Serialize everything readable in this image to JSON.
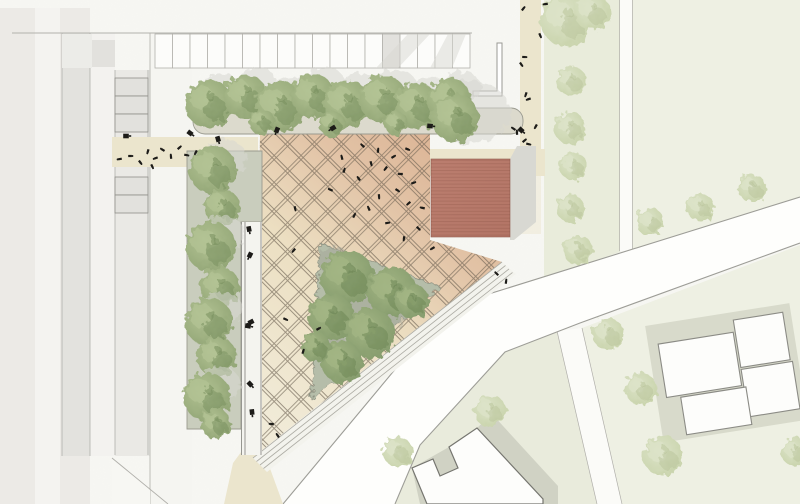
{
  "canvas": {
    "w": 800,
    "h": 504
  },
  "title": "site-plan",
  "colors": {
    "bg": "#f7f7f3",
    "noise": "#9a9a90",
    "slab": "#eceae6",
    "slab_seam": "#f4f3f0",
    "wing": "#e3e2de",
    "aisle": "#f3f2ef",
    "stall_col_bg": "#eae9e5",
    "sidewalk": "#f5f5f1",
    "stall_fill": "#fcfcfa",
    "stall_gray": "#e2e1dd",
    "stall_line": "#b2b1ac",
    "thin_line": "#b0afaa",
    "block_pale": "#eef0e3",
    "block_pale2": "#e9ebdc",
    "green_strip": "#e9ecdb",
    "street_white": "#fbfbf8",
    "road_fill": "#fefefc",
    "road_line": "#9d9d97",
    "beige": "#ebe5cd",
    "plaza_g1": "#f1ebd8",
    "plaza_g2": "#ecdfc2",
    "plaza_g3": "#e2c3a6",
    "plaza_g4": "#dcb495",
    "grid_line": "#6b5f50",
    "steps_fill": "#f3f3ed",
    "steps_line": "#adaca4",
    "planter_bed": "#dcdacd",
    "planter_strip": "#c9cdbd",
    "planter_line": "#9a9a8f",
    "walkway": "#f4f4ef",
    "wall_line": "#8d8c86",
    "triangle_fill": "#b5bda9",
    "triangle_line": "#8f9383",
    "triangle_spot": "#a3a698",
    "shadow": "#d8d8d2",
    "red_roof": "#b37566",
    "red_roof_hi": "#bb7e6f",
    "red_stripe": "#5a281e",
    "red_line": "#8f5a4d",
    "gray_bldg_shadow": "#d0d2c4",
    "bldg_white": "#fdfdfb",
    "bldg_line": "#75756f",
    "white_bldg_line": "#8b8b85",
    "white_bldg_shadow": "#d8dacb",
    "tree_g1": "#b3c394",
    "tree_g2": "#8ea272",
    "tree_g3": "#718a58",
    "tree_d1": "#a3b584",
    "tree_d2": "#82996a",
    "tree_d3": "#66804f",
    "tree_p1": "#dce3c8",
    "tree_p2": "#c7d2a9",
    "tree_p3": "#b5c296",
    "figure": "#1c1b18"
  },
  "left_complex": {
    "slab": [
      0,
      8,
      90,
      496
    ],
    "seam": [
      35,
      8,
      25,
      496
    ],
    "wing": [
      62,
      33,
      28,
      423
    ],
    "aisle": [
      90,
      33,
      25,
      423
    ],
    "stall_col": [
      115,
      70,
      35,
      386
    ],
    "sidewalk": [
      150,
      33,
      42,
      471
    ],
    "diag_cut": "112,458 150,490 150,504 112,504",
    "col_rows": [
      [
        115,
        78,
        33,
        18
      ],
      [
        115,
        96,
        33,
        18
      ],
      [
        115,
        114,
        33,
        18
      ],
      [
        115,
        177,
        33,
        18
      ],
      [
        115,
        195,
        33,
        18
      ]
    ]
  },
  "top_strip": {
    "edge_y": 33,
    "edge_x1": 12,
    "edge_x2": 472,
    "gray_a": [
      62,
      34,
      30,
      34
    ],
    "gray_b": [
      92,
      40,
      23,
      27
    ],
    "stalls": {
      "x": 155,
      "y": 34,
      "w": 17.5,
      "h": 34,
      "count": 18,
      "gray_index": 13
    },
    "shadow_polys": [
      "408,34 430,34 398,68 376,68",
      "448,34 466,34 452,68 430,68"
    ],
    "l_wall": "M473,91 h24 V43 h5 v53 h-29 z"
  },
  "right_blocks": {
    "top_right": "632,0 800,0 800,197 632,249",
    "green_strip": "544,0 620,0 620,252 544,278",
    "beige_strip": [
      520,
      0,
      21,
      176
    ],
    "beige_tail": [
      520,
      176,
      21,
      58
    ],
    "v_street": [
      620,
      0,
      12,
      251
    ],
    "bottom_center": "557,331 505,352 420,445 395,504 597,504",
    "bottom_right": "582,328 800,245 800,504 622,504",
    "street_below": "557,331 582,328 622,504 597,504"
  },
  "road": {
    "fill": "800,197 447,307 283,504 395,504 420,445 505,352 580,323 800,243",
    "upper_edge": "M800,197 L447,307 L283,504",
    "lower_edge": "M800,243 L580,323 L505,352 L420,445 L395,504"
  },
  "paths": {
    "band_w": [
      112,
      137,
      146,
      30
    ],
    "band_e": [
      428,
      149,
      117,
      27
    ],
    "sw_wedge": "250,440 264,452 283,504 224,504 233,463"
  },
  "plaza": {
    "outline": "260,133 430,133 430,240 502,262 310,412 256,455",
    "grid_cell": 19,
    "steps_band": "502,262 516,274 267,472 253,458",
    "steps_lines": [
      0,
      5,
      10,
      15
    ],
    "walkway": [
      241,
      222,
      21,
      233
    ],
    "triangle": "320,243 440,287 312,400",
    "triangle_spots": [
      [
        335,
        262,
        16
      ],
      [
        357,
        302,
        18
      ],
      [
        332,
        346,
        14
      ],
      [
        392,
        312,
        15
      ]
    ]
  },
  "planters": {
    "top_bed": [
      193,
      108,
      330,
      26
    ],
    "left_strip": "187,151 262,151 262,222 241,222 241,429 187,429"
  },
  "red_building": {
    "rect": [
      431,
      159,
      79,
      78
    ],
    "shadow": "510,159 517,146 536,146 536,222 514,240 510,240",
    "nw_shade": [
      468,
      112,
      42,
      32
    ]
  },
  "gray_building": {
    "shadow": "412,468 449,447 477,428 492,414 558,486 558,504 420,504",
    "outline": "M477,428 L543,499 L543,504 L427,504 L412,468 L433,459 L440,476 L458,468 L449,447 Z"
  },
  "white_buildings": {
    "rotate": [
      -9,
      725,
      370
    ],
    "shadow": [
      653,
      314,
      146,
      118
    ],
    "rects": [
      [
        663,
        334,
        76,
        54
      ],
      [
        741,
        322,
        50,
        48
      ],
      [
        741,
        372,
        52,
        48
      ],
      [
        677,
        390,
        66,
        38
      ]
    ]
  },
  "trees": [
    {
      "x": 209,
      "y": 104,
      "r": 24,
      "k": "g",
      "s": 1
    },
    {
      "x": 245,
      "y": 96,
      "r": 22,
      "k": "g",
      "s": 1
    },
    {
      "x": 280,
      "y": 107,
      "r": 25,
      "k": "g",
      "s": 1
    },
    {
      "x": 313,
      "y": 96,
      "r": 22,
      "k": "g",
      "s": 1
    },
    {
      "x": 347,
      "y": 104,
      "r": 24,
      "k": "g",
      "s": 1
    },
    {
      "x": 383,
      "y": 99,
      "r": 24,
      "k": "g",
      "s": 1
    },
    {
      "x": 417,
      "y": 106,
      "r": 23,
      "k": "g",
      "s": 1
    },
    {
      "x": 449,
      "y": 100,
      "r": 22,
      "k": "g",
      "s": 1
    },
    {
      "x": 262,
      "y": 122,
      "r": 13,
      "k": "g",
      "s": 0
    },
    {
      "x": 332,
      "y": 124,
      "r": 13,
      "k": "g",
      "s": 0
    },
    {
      "x": 396,
      "y": 123,
      "r": 12,
      "k": "g",
      "s": 0
    },
    {
      "x": 455,
      "y": 118,
      "r": 24,
      "k": "g",
      "s": 0
    },
    {
      "x": 213,
      "y": 170,
      "r": 24,
      "k": "g",
      "s": 1
    },
    {
      "x": 222,
      "y": 207,
      "r": 18,
      "k": "g",
      "s": 0
    },
    {
      "x": 211,
      "y": 247,
      "r": 25,
      "k": "g",
      "s": 1
    },
    {
      "x": 220,
      "y": 287,
      "r": 20,
      "k": "g",
      "s": 0
    },
    {
      "x": 209,
      "y": 322,
      "r": 24,
      "k": "g",
      "s": 1
    },
    {
      "x": 217,
      "y": 357,
      "r": 20,
      "k": "g",
      "s": 0
    },
    {
      "x": 207,
      "y": 397,
      "r": 24,
      "k": "g",
      "s": 1
    },
    {
      "x": 216,
      "y": 424,
      "r": 15,
      "k": "g",
      "s": 0
    },
    {
      "x": 347,
      "y": 277,
      "r": 27,
      "k": "d",
      "s": 0
    },
    {
      "x": 392,
      "y": 292,
      "r": 25,
      "k": "d",
      "s": 0
    },
    {
      "x": 331,
      "y": 317,
      "r": 23,
      "k": "d",
      "s": 0
    },
    {
      "x": 370,
      "y": 333,
      "r": 25,
      "k": "d",
      "s": 0
    },
    {
      "x": 342,
      "y": 362,
      "r": 21,
      "k": "d",
      "s": 0
    },
    {
      "x": 412,
      "y": 301,
      "r": 17,
      "k": "d",
      "s": 0
    },
    {
      "x": 316,
      "y": 347,
      "r": 15,
      "k": "d",
      "s": 0
    },
    {
      "x": 566,
      "y": 20,
      "r": 26,
      "k": "p",
      "s": 0
    },
    {
      "x": 592,
      "y": 12,
      "r": 18,
      "k": "p",
      "s": 0
    },
    {
      "x": 571,
      "y": 81,
      "r": 15,
      "k": "p",
      "s": 0
    },
    {
      "x": 570,
      "y": 128,
      "r": 16,
      "k": "p",
      "s": 0
    },
    {
      "x": 573,
      "y": 166,
      "r": 14,
      "k": "p",
      "s": 0
    },
    {
      "x": 570,
      "y": 208,
      "r": 14,
      "k": "p",
      "s": 0
    },
    {
      "x": 578,
      "y": 250,
      "r": 15,
      "k": "p",
      "s": 0
    },
    {
      "x": 650,
      "y": 222,
      "r": 14,
      "k": "p",
      "s": 0
    },
    {
      "x": 700,
      "y": 207,
      "r": 14,
      "k": "p",
      "s": 0
    },
    {
      "x": 752,
      "y": 188,
      "r": 14,
      "k": "p",
      "s": 0
    },
    {
      "x": 608,
      "y": 334,
      "r": 16,
      "k": "p",
      "s": 0
    },
    {
      "x": 641,
      "y": 389,
      "r": 16,
      "k": "p",
      "s": 0
    },
    {
      "x": 663,
      "y": 456,
      "r": 20,
      "k": "p",
      "s": 0
    },
    {
      "x": 795,
      "y": 452,
      "r": 14,
      "k": "p",
      "s": 0
    },
    {
      "x": 490,
      "y": 411,
      "r": 16,
      "k": "p",
      "s": 0
    },
    {
      "x": 398,
      "y": 452,
      "r": 15,
      "k": "p",
      "s": 0
    }
  ],
  "persons": [
    [
      130,
      156
    ],
    [
      140,
      162
    ],
    [
      148,
      151
    ],
    [
      156,
      158
    ],
    [
      163,
      150
    ],
    [
      171,
      157
    ],
    [
      179,
      148
    ],
    [
      186,
      155
    ],
    [
      152,
      166
    ],
    [
      196,
      152
    ],
    [
      120,
      159
    ],
    [
      363,
      146
    ],
    [
      378,
      151
    ],
    [
      393,
      157
    ],
    [
      407,
      149
    ],
    [
      371,
      163
    ],
    [
      386,
      168
    ],
    [
      401,
      174
    ],
    [
      359,
      179
    ],
    [
      344,
      171
    ],
    [
      413,
      183
    ],
    [
      397,
      190
    ],
    [
      379,
      196
    ],
    [
      409,
      203
    ],
    [
      423,
      208
    ],
    [
      369,
      209
    ],
    [
      354,
      216
    ],
    [
      387,
      223
    ],
    [
      418,
      228
    ],
    [
      404,
      238
    ],
    [
      433,
      248
    ],
    [
      331,
      190
    ],
    [
      342,
      158
    ],
    [
      523,
      9
    ],
    [
      524,
      57
    ],
    [
      521,
      64
    ],
    [
      526,
      94
    ],
    [
      529,
      99
    ],
    [
      514,
      129
    ],
    [
      517,
      133
    ],
    [
      524,
      141
    ],
    [
      528,
      144
    ],
    [
      540,
      35
    ],
    [
      536,
      126
    ],
    [
      546,
      4
    ],
    [
      497,
      274
    ],
    [
      506,
      282
    ],
    [
      318,
      329
    ],
    [
      285,
      319
    ],
    [
      295,
      208
    ],
    [
      294,
      250
    ],
    [
      272,
      424
    ],
    [
      278,
      436
    ],
    [
      303,
      352
    ]
  ],
  "benches": [
    [
      126,
      136
    ],
    [
      190,
      133
    ],
    [
      218,
      139
    ],
    [
      277,
      130
    ],
    [
      333,
      128
    ],
    [
      430,
      126
    ],
    [
      521,
      130
    ],
    [
      249,
      229
    ],
    [
      250,
      255
    ],
    [
      251,
      322
    ],
    [
      248,
      326
    ],
    [
      250,
      384
    ],
    [
      252,
      412
    ]
  ]
}
